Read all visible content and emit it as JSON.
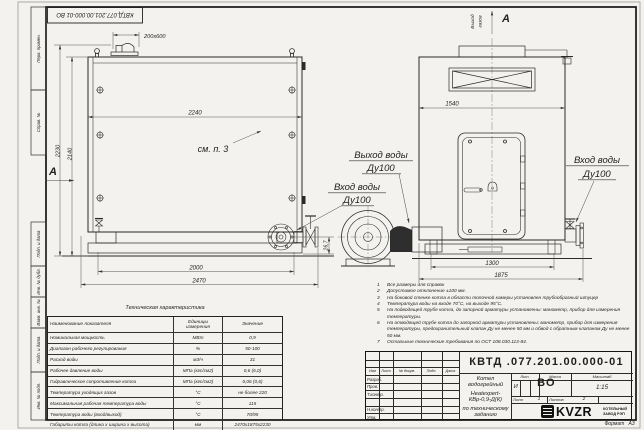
{
  "sheet": {
    "stamp_top_designation": "КВТД.077.201.00.000-01 ВО",
    "format_label": "Формат",
    "format_value": "А3"
  },
  "margin_labels": {
    "perv_primen": "Перв. примен.",
    "sprav_no": "Справ. №",
    "podp_data_1": "Подп. и дата",
    "inv_dubl": "Инв. № дубл.",
    "vzam_inv": "Взам. инв. №",
    "podp_data_2": "Подп. и дата",
    "inv_podl": "Инв. № подл."
  },
  "side_view": {
    "dim_duct": "200х600",
    "dim_top_width": "2240",
    "dim_height_overall": "2230",
    "dim_height_body": "2140",
    "dim_supports": "2000",
    "dim_overall_length": "2470",
    "dim_port_offset": "26,7",
    "see_note": "см. п. 3",
    "view_letter": "А"
  },
  "front_view": {
    "dim_top_width": "1540",
    "dim_supports": "1300",
    "dim_overall_width": "1875",
    "gas_outlet_line1": "Выход",
    "gas_outlet_line2": "газов",
    "view_letter": "А",
    "water_inlet_line1": "Вход воды",
    "water_inlet_line2": "Ду100"
  },
  "pipe_labels": {
    "water_outlet_line1": "Выход воды",
    "water_outlet_line2": "Ду100",
    "water_inlet_line1": "Вход воды",
    "water_inlet_line2": "Ду100"
  },
  "spec_table": {
    "title": "Техническая характеристика",
    "col_name": "Наименование показателя",
    "col_units": "Единицы измерения",
    "col_value": "Значение",
    "rows": [
      [
        "Номинальная мощность",
        "МВт",
        "0,9"
      ],
      [
        "Диапазон рабочего регулирования",
        "%",
        "50-100"
      ],
      [
        "Расход воды",
        "м3/ч",
        "31"
      ],
      [
        "Рабочее давление воды",
        "МПа (кгс/см2)",
        "0,6 (6,0)"
      ],
      [
        "Гидравлическое сопротивление котла",
        "МПа (кгс/см2)",
        "0,06 (0,6)"
      ],
      [
        "Температура уходящих газов",
        "°С",
        "не более 220"
      ],
      [
        "Максимальная рабочая температура воды",
        "°С",
        "115"
      ],
      [
        "Температура воды (вход/выход)",
        "°С",
        "70/95"
      ],
      [
        "Габариты котла (длина х ширина х высота)",
        "мм",
        "2470х1875х2230"
      ]
    ]
  },
  "notes": [
    {
      "n": "1",
      "t": "Все размеры для справок"
    },
    {
      "n": "2",
      "t": "Допустимое отклонение ±100 мм."
    },
    {
      "n": "3",
      "t": "На боковой стенке котла в области топочной камеры установлен трубообразный штуцер"
    },
    {
      "n": "4",
      "t": "Температура воды на входе 70°С, на выходе 95°С."
    },
    {
      "n": "5",
      "t": "На подводящей трубе котла, до запорной арматуры установлены: манометр, прибор для измерения температуры."
    },
    {
      "n": "6",
      "t": "На отводящей трубе котла до запорной арматуры установлены: манометр, прибор для измерения температуры, предохранительный клапан Ду не менее 50 мм и обвод с обратным клапаном Ду не менее 50 мм."
    },
    {
      "n": "7",
      "t": "Остальные технические требования по ОСТ 108.030.113-84."
    }
  ],
  "title_block": {
    "designation": "КВТД .077.201.00.000-01 ВО",
    "name_line1": "Котел водогрейный",
    "name_line2": "Heatexpert-КВр-0,9-Д(К)",
    "name_line3": "по техническому заданию",
    "col_izm": "Изм",
    "col_list": "Лист",
    "col_ndoc": "№ докум.",
    "col_podp": "Подп.",
    "col_data": "Дата",
    "row_razrab": "Разраб.",
    "row_prov": "Пров.",
    "row_tkontr": "Т.контр.",
    "row_nkontr": "Н.контр.",
    "row_utv": "Утв.",
    "lit_label": "Лит.",
    "lit_value": "И",
    "massa_label": "Масса",
    "masshtab_label": "Масштаб",
    "masshtab_value": "1:15",
    "list_label": "Лист",
    "list_value": "1",
    "listov_label": "Листов",
    "listov_value": "2",
    "logo_text": "KVZR",
    "logo_sub1": "КОТЕЛЬНЫЙ",
    "logo_sub2": "ЗАВОД РЭП"
  }
}
